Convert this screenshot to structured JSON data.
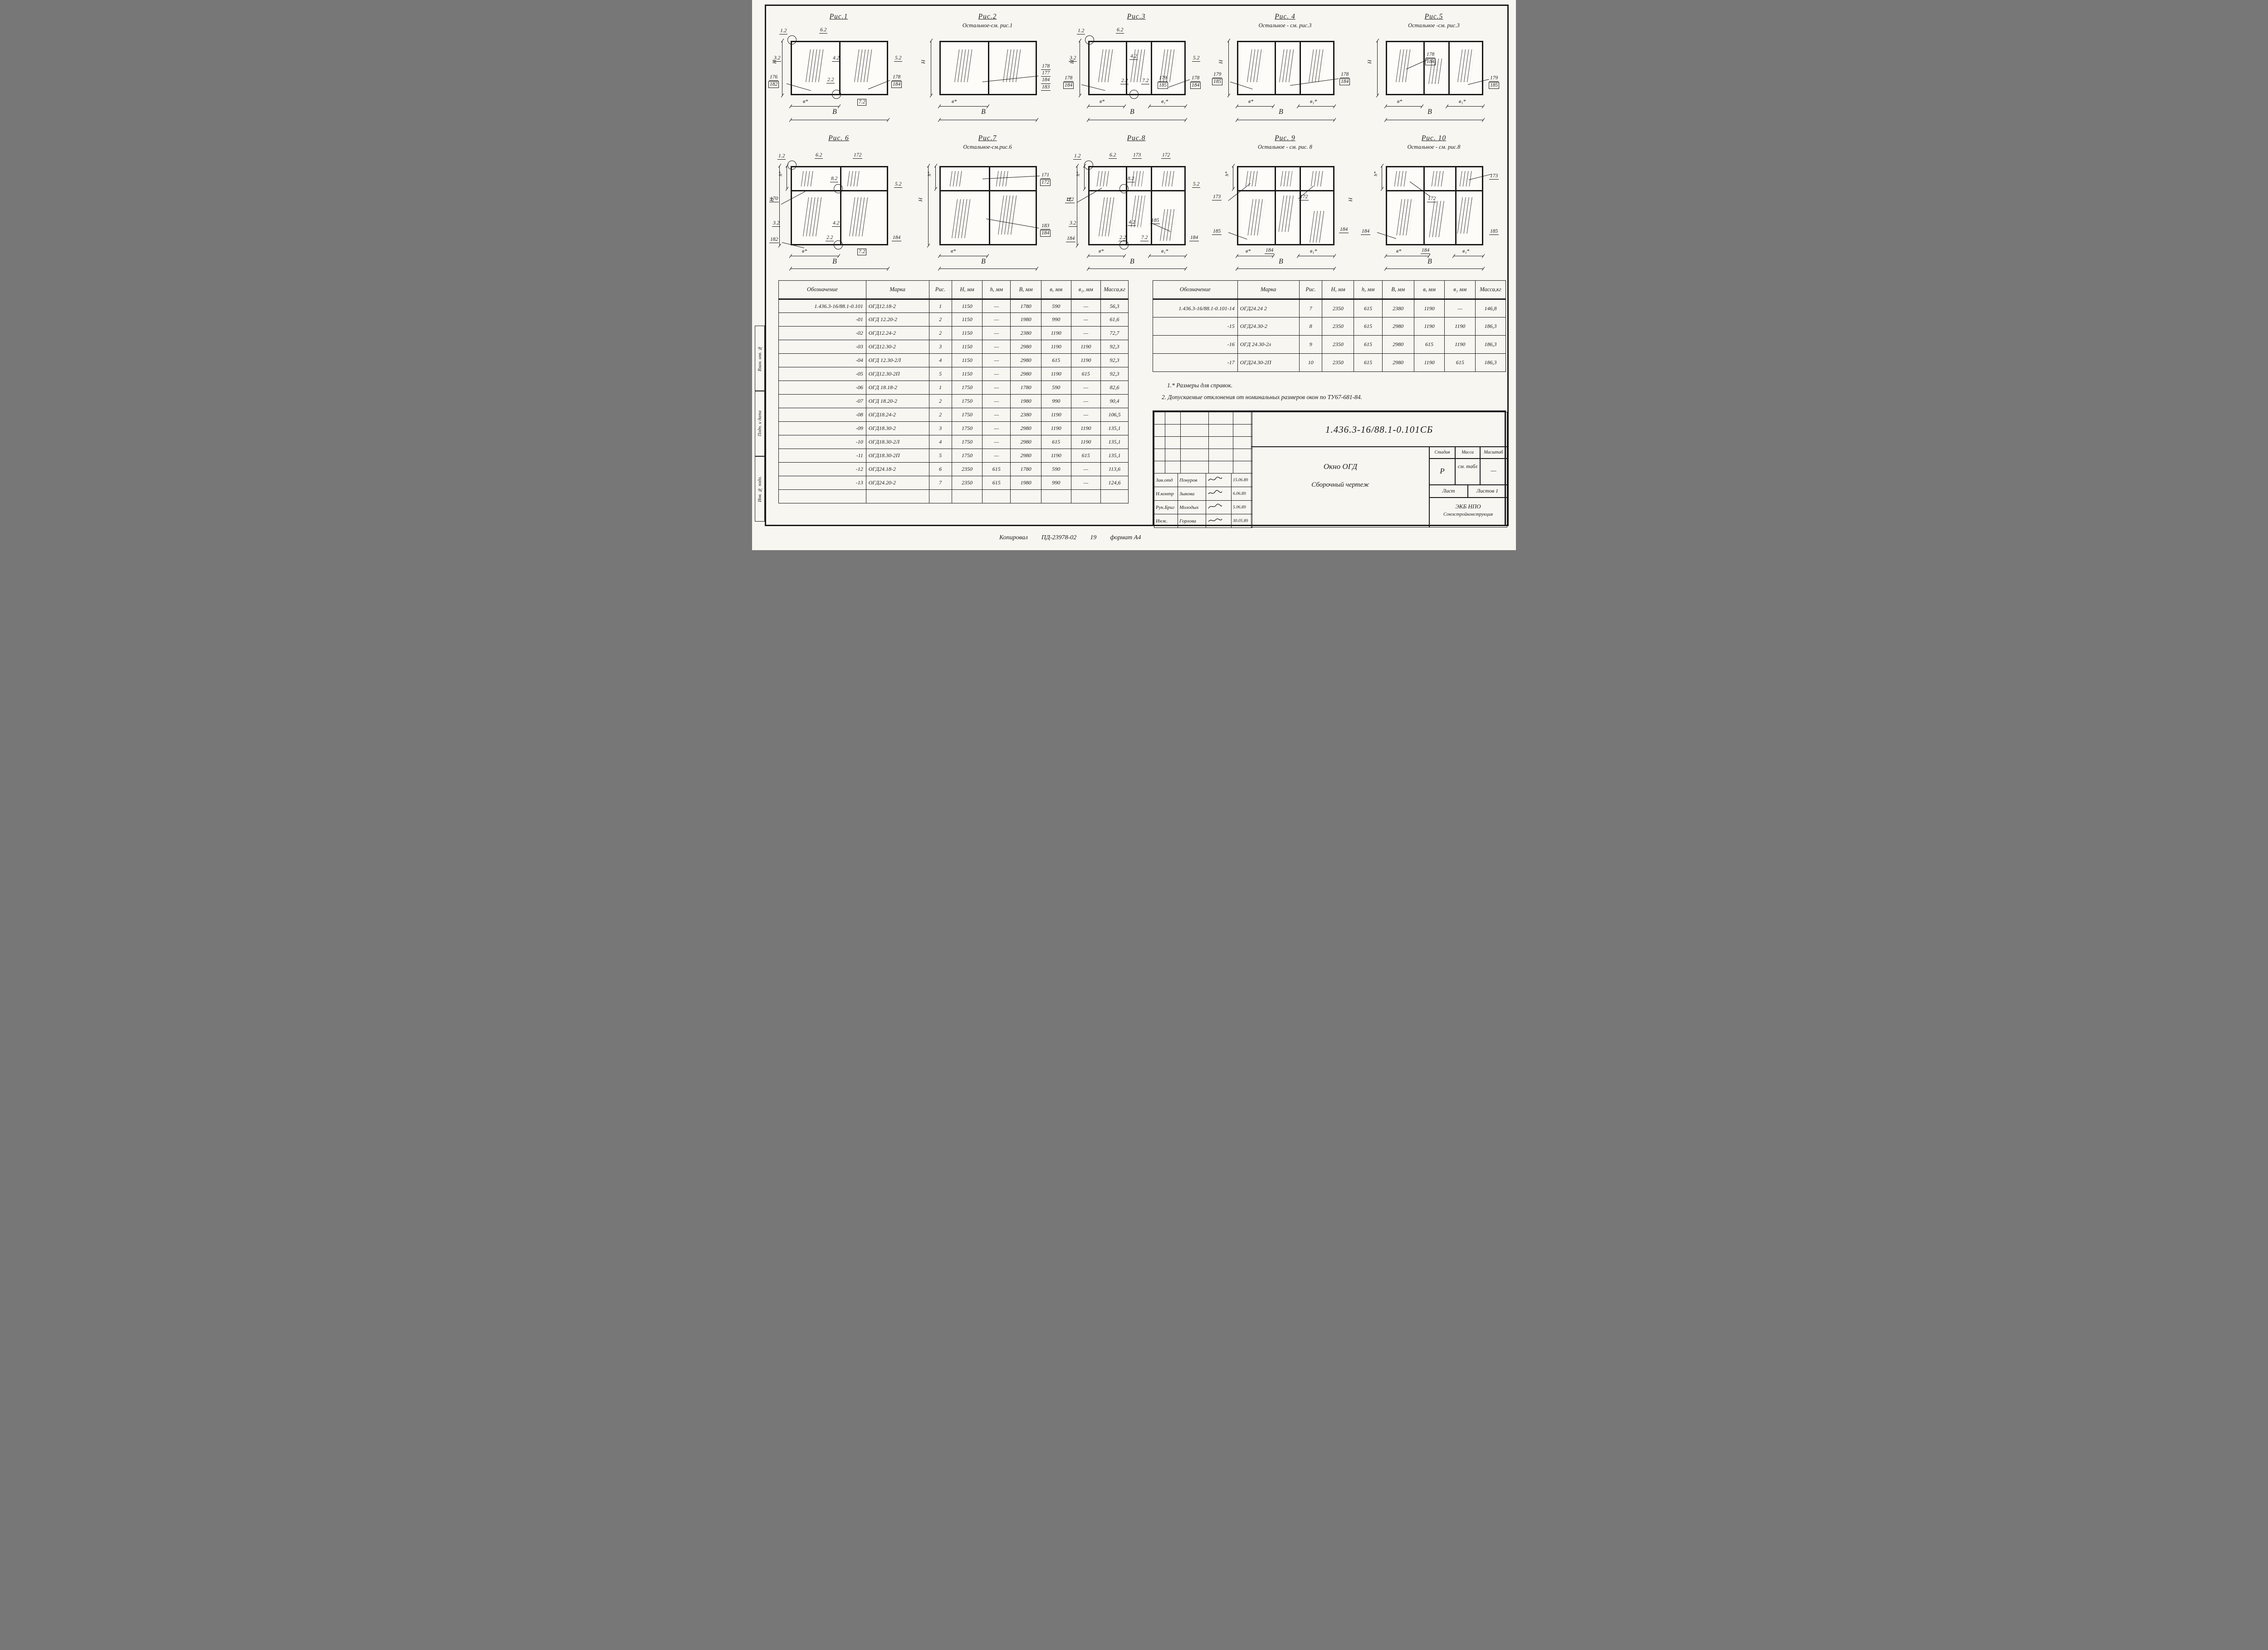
{
  "colors": {
    "ink": "#1a1a1a",
    "paper": "#f7f6f1"
  },
  "figures": [
    {
      "title": "Рис.1",
      "subtitle": "",
      "labels": [
        "1.2",
        "6.2",
        "3.2",
        "4.2",
        "5.2",
        "176",
        "182",
        "2.2",
        "178",
        "184",
        "7.2",
        "в*",
        "В",
        "Н"
      ]
    },
    {
      "title": "Рис.2",
      "subtitle": "Остальное-см. рис.1",
      "labels": [
        "178",
        "177",
        "184",
        "183",
        "в*",
        "В",
        "Н"
      ]
    },
    {
      "title": "Рис.3",
      "subtitle": "",
      "labels": [
        "1.2",
        "6.2",
        "3.2",
        "4.2",
        "5.2",
        "178",
        "184",
        "2.2",
        "7.2",
        "179",
        "185",
        "178",
        "184",
        "в*",
        "в₁*",
        "В",
        "Н"
      ]
    },
    {
      "title": "Рис. 4",
      "subtitle": "Остальное - см. рис.3",
      "labels": [
        "179",
        "185",
        "178",
        "184",
        "в*",
        "в₁*",
        "В",
        "Н"
      ]
    },
    {
      "title": "Рис.5",
      "subtitle": "Остальное -см. рис.3",
      "labels": [
        "178",
        "184",
        "179",
        "185",
        "в*",
        "в₁*",
        "В",
        "Н"
      ]
    },
    {
      "title": "Рис. 6",
      "subtitle": "",
      "labels": [
        "1.2",
        "6.2",
        "172",
        "8.2",
        "5.2",
        "170",
        "3.2",
        "4.2",
        "182",
        "2.2",
        "184",
        "7.2",
        "в*",
        "В",
        "Н",
        "h*"
      ]
    },
    {
      "title": "Рис.7",
      "subtitle": "Остальное-см.рис.6",
      "labels": [
        "171",
        "172",
        "183",
        "184",
        "в*",
        "В",
        "Н",
        "h*"
      ]
    },
    {
      "title": "Рис.8",
      "subtitle": "",
      "labels": [
        "1.2",
        "6.2",
        "173",
        "172",
        "8.2",
        "5.2",
        "172",
        "3.2",
        "4.2",
        "185",
        "184",
        "2.2",
        "7.2",
        "184",
        "в*",
        "в₁*",
        "В",
        "Н",
        "h*"
      ]
    },
    {
      "title": "Рис. 9",
      "subtitle": "Остальное - см. рис. 8",
      "labels": [
        "173",
        "172",
        "185",
        "184",
        "184",
        "в*",
        "в₁*",
        "В",
        "Н",
        "h*"
      ]
    },
    {
      "title": "Рис. 10",
      "subtitle": "Остальное - см. рис.8",
      "labels": [
        "173",
        "172",
        "184",
        "184",
        "185",
        "в*",
        "в₁*",
        "В",
        "h*"
      ]
    }
  ],
  "left_table": {
    "headers": [
      "Обозначение",
      "Марка",
      "Рис.",
      "Н, мм",
      "h, мм",
      "В, мм",
      "в, мм",
      "в₁, мм",
      "Масса,кг"
    ],
    "rows": [
      [
        "1.436.3-16/88.1-0.101",
        "ОГД12.18-2",
        "1",
        "1150",
        "—",
        "1780",
        "590",
        "—",
        "56,3"
      ],
      [
        "-01",
        "ОГД 12.20-2",
        "2",
        "1150",
        "—",
        "1980",
        "990",
        "—",
        "61,6"
      ],
      [
        "-02",
        "ОГД12.24-2",
        "2",
        "1150",
        "—",
        "2380",
        "1190",
        "—",
        "72,7"
      ],
      [
        "-03",
        "ОГД12.30-2",
        "3",
        "1150",
        "—",
        "2980",
        "1190",
        "1190",
        "92,3"
      ],
      [
        "-04",
        "ОГД 12.30-2Л",
        "4",
        "1150",
        "—",
        "2980",
        "615",
        "1190",
        "92,3"
      ],
      [
        "-05",
        "ОГД12.30-2П",
        "5",
        "1150",
        "—",
        "2980",
        "1190",
        "615",
        "92,3"
      ],
      [
        "-06",
        "ОГД 18.18-2",
        "1",
        "1750",
        "—",
        "1780",
        "590",
        "—",
        "82,6"
      ],
      [
        "-07",
        "ОГД 18.20-2",
        "2",
        "1750",
        "—",
        "1980",
        "990",
        "—",
        "90,4"
      ],
      [
        "-08",
        "ОГД18.24-2",
        "2",
        "1750",
        "—",
        "2380",
        "1190",
        "—",
        "106,5"
      ],
      [
        "-09",
        "ОГД18.30-2",
        "3",
        "1750",
        "—",
        "2980",
        "1190",
        "1190",
        "135,1"
      ],
      [
        "-10",
        "ОГД18.30-2Л",
        "4",
        "1750",
        "—",
        "2980",
        "615",
        "1190",
        "135,1"
      ],
      [
        "-11",
        "ОГД18.30-2П",
        "5",
        "1750",
        "—",
        "2980",
        "1190",
        "615",
        "135,1"
      ],
      [
        "-12",
        "ОГД24.18-2",
        "6",
        "2350",
        "615",
        "1780",
        "590",
        "—",
        "113,6"
      ],
      [
        "-13",
        "ОГД24.20-2",
        "7",
        "2350",
        "615",
        "1980",
        "990",
        "—",
        "124,6"
      ],
      [
        "",
        "",
        "",
        "",
        "",
        "",
        "",
        "",
        ""
      ]
    ]
  },
  "right_table": {
    "headers": [
      "Обозначение",
      "Марка",
      "Рис.",
      "Н, мм",
      "h, мм",
      "В, мм",
      "в, мм",
      "в₁ мм",
      "Масса,кг"
    ],
    "rows": [
      [
        "1.436.3-16/88.1-0.101-14",
        "ОГД24.24 2",
        "7",
        "2350",
        "615",
        "2380",
        "1190",
        "—",
        "146,8"
      ],
      [
        "-15",
        "ОГД24.30-2",
        "8",
        "2350",
        "615",
        "2980",
        "1190",
        "1190",
        "186,3"
      ],
      [
        "-16",
        "ОГД 24.30-2л",
        "9",
        "2350",
        "615",
        "2980",
        "615",
        "1190",
        "186,3"
      ],
      [
        "-17",
        "ОГД24.30-2П",
        "10",
        "2350",
        "615",
        "2980",
        "1190",
        "615",
        "186,3"
      ]
    ]
  },
  "notes": {
    "n1": "1.* Размеры для справок.",
    "n2": "2. Допускаемые отклонения от номинальных размеров окон по ТУ67-681-84."
  },
  "sheet": {
    "doc_number": "1.436.3-16/88.1-0.101СБ",
    "title_line1": "Окно ОГД",
    "title_line2": "Сборочный чертеж",
    "stage_label": "Стадия",
    "mass_label": "Масса",
    "scale_label": "Масштаб",
    "stage_value": "Р",
    "mass_value": "см. табл",
    "scale_value": "—",
    "sheet_label": "Лист",
    "sheets_label": "Листов 1",
    "org_line1": "ЭКБ НПО",
    "org_line2": "Союзстройконструкция",
    "signatures": [
      {
        "role": "Зав.отд",
        "name": "Понуров",
        "date": "15.06.89"
      },
      {
        "role": "Н.контр",
        "name": "Зыкова",
        "date": "6.06.89"
      },
      {
        "role": "Рук.Бриг",
        "name": "Молодых",
        "date": "5.06.89"
      },
      {
        "role": "Инж.",
        "name": "Горлова",
        "date": "30.05.89"
      }
    ],
    "side_labels": [
      "Взам. инв. №",
      "Подп. и дата",
      "Инв. № подл."
    ],
    "footer": {
      "copied": "Копировал",
      "doc": "ПД-23978-02",
      "num": "19",
      "format": "формат А4"
    }
  }
}
